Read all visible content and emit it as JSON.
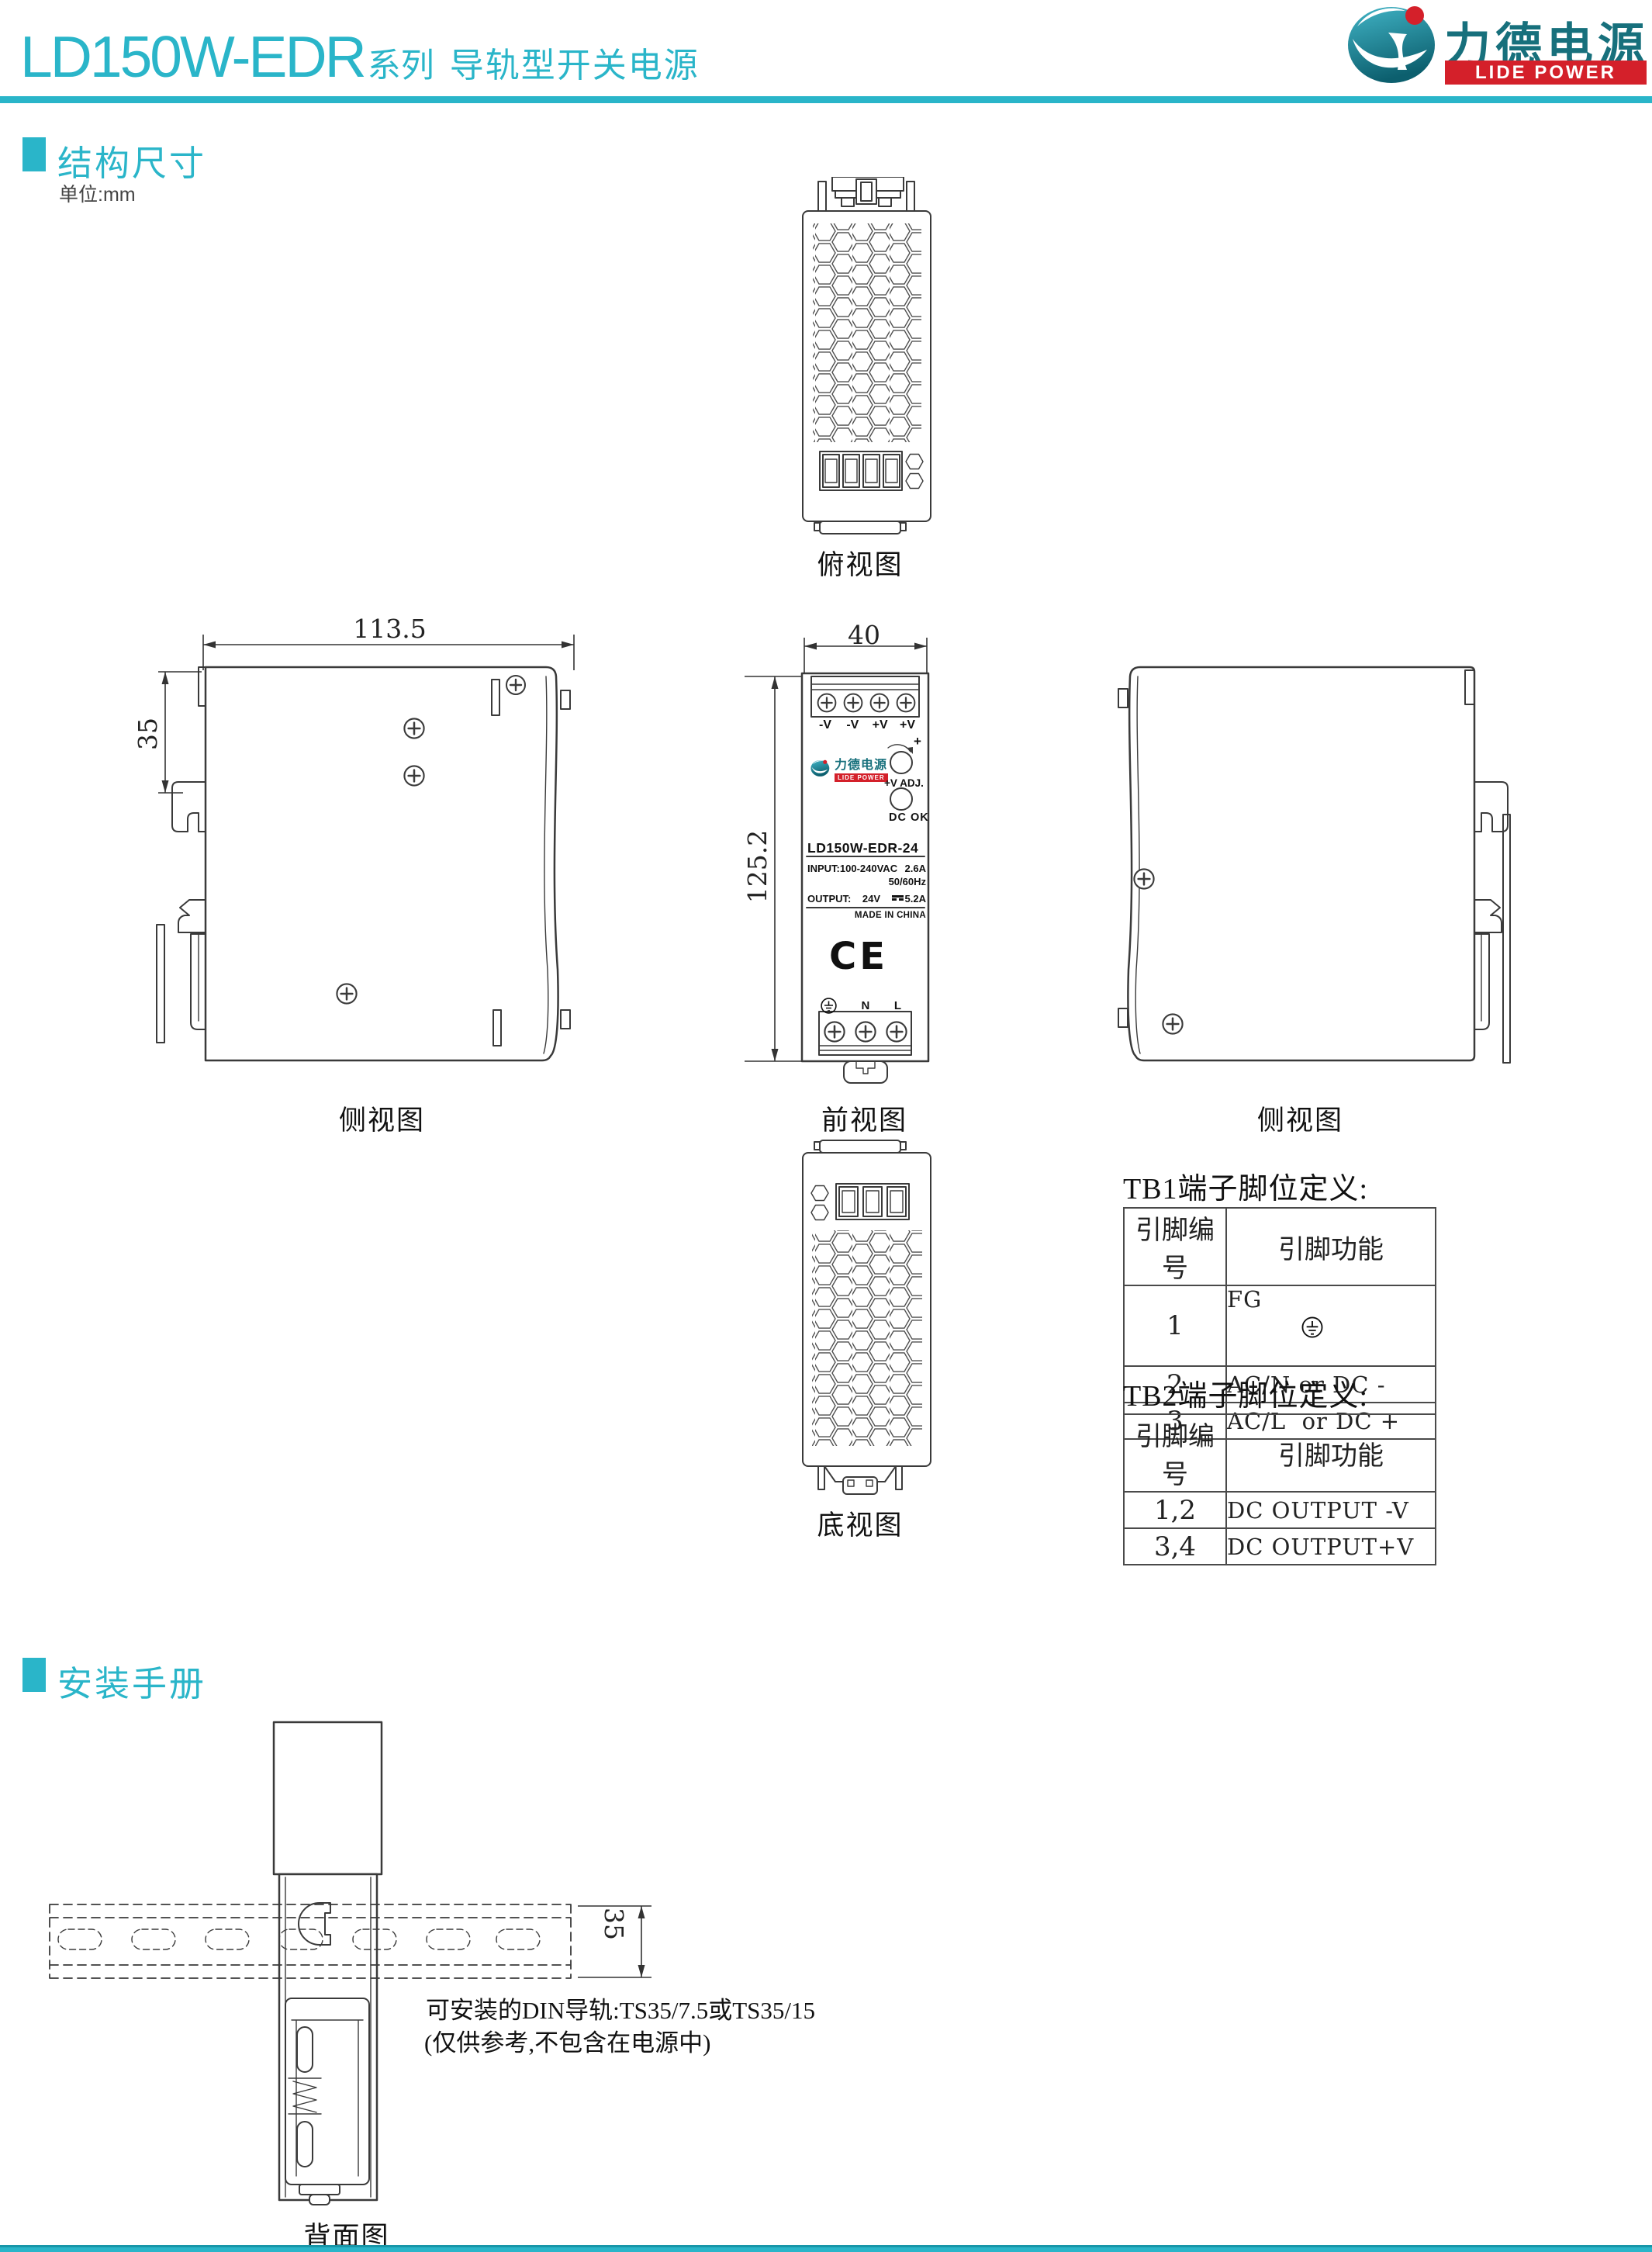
{
  "colors": {
    "teal": "#2ab5c9",
    "logo_teal": "#17707c",
    "red": "#d4202a",
    "line": "#3a3a3a"
  },
  "header": {
    "title_main": "LD150W-EDR",
    "title_suffix": "系列",
    "title_rest": "导轨型开关电源",
    "logo_cn": "力德电源",
    "logo_en": "LIDE POWER"
  },
  "sections": {
    "structure": {
      "title": "结构尺寸",
      "unit": "单位:mm"
    },
    "install": {
      "title": "安装手册"
    }
  },
  "views": {
    "top_label": "俯视图",
    "front_label": "前视图",
    "side_left_label": "侧视图",
    "side_right_label": "侧视图",
    "bottom_label": "底视图",
    "back_label": "背面图"
  },
  "dims": {
    "front_width": "40",
    "front_height": "125.2",
    "side_width": "113.5",
    "side_rail": "35",
    "install_rail": "35"
  },
  "front_panel": {
    "terminals_top": [
      "-V",
      "-V",
      "+V",
      "+V"
    ],
    "logo_cn": "力德电源",
    "logo_en": "LIDE POWER",
    "adj_plus": "+",
    "adj_label": "+V ADJ.",
    "dc_ok": "DC OK",
    "model": "LD150W-EDR-24",
    "input_label": "INPUT:100-240VAC",
    "input_current": "2.6A",
    "input_freq": "50/60Hz",
    "output_label": "OUTPUT:",
    "output_voltage": "24V",
    "output_current": "5.2A",
    "made_in": "MADE IN CHINA",
    "ce_mark": "CE",
    "terminal_n": "N",
    "terminal_l": "L"
  },
  "tables": {
    "tb1": {
      "title": "TB1端子脚位定义:",
      "col1": "引脚编号",
      "col2": "引脚功能",
      "rows": [
        {
          "pin": "1",
          "func": "FG"
        },
        {
          "pin": "2",
          "func": "AC/N or DC -"
        },
        {
          "pin": "3",
          "func": "AC/L  or DC +"
        }
      ]
    },
    "tb2": {
      "title": "TB2端子脚位定义:",
      "col1": "引脚编号",
      "col2": "引脚功能",
      "rows": [
        {
          "pin": "1,2",
          "func": "DC OUTPUT -V"
        },
        {
          "pin": "3,4",
          "func": "DC OUTPUT+V"
        }
      ]
    }
  },
  "install": {
    "note1": "可安装的DIN导轨:TS35/7.5或TS35/15",
    "note2": "(仅供参考,不包含在电源中)"
  }
}
